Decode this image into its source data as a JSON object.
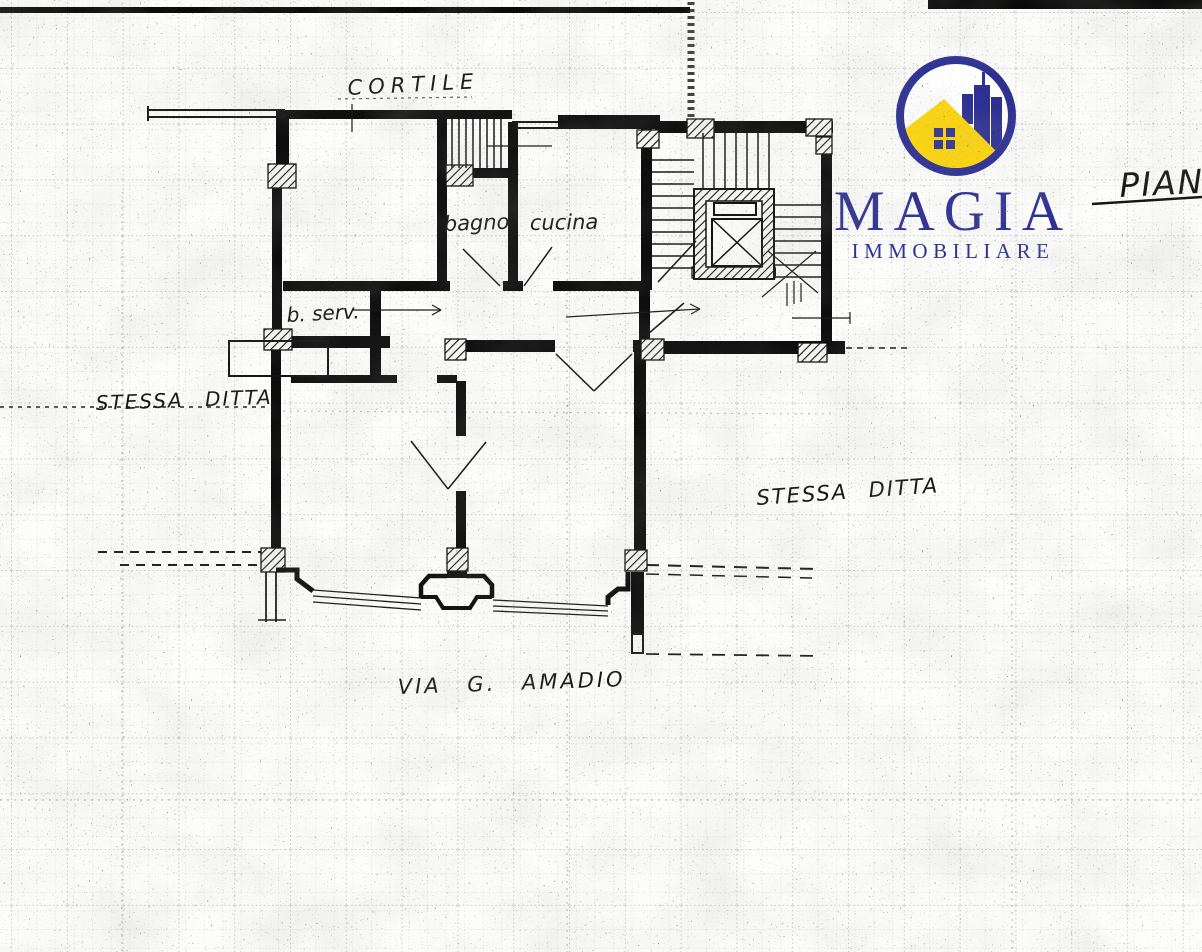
{
  "plan": {
    "labels": {
      "cortile": "CORTILE",
      "bagno": "bagno",
      "cucina": "cucina",
      "b_serv": "b. serv.",
      "stessa_ditta_left": "STESSA DITTA",
      "stessa_ditta_right": "STESSA DITTA",
      "via": "VIA G. AMADIO",
      "pian": "PIAN"
    }
  },
  "logo": {
    "name": "MAGIA",
    "subtitle": "IMMOBILIARE",
    "colors": {
      "blue": "#2e3192",
      "yellow": "#ffd60a"
    }
  }
}
